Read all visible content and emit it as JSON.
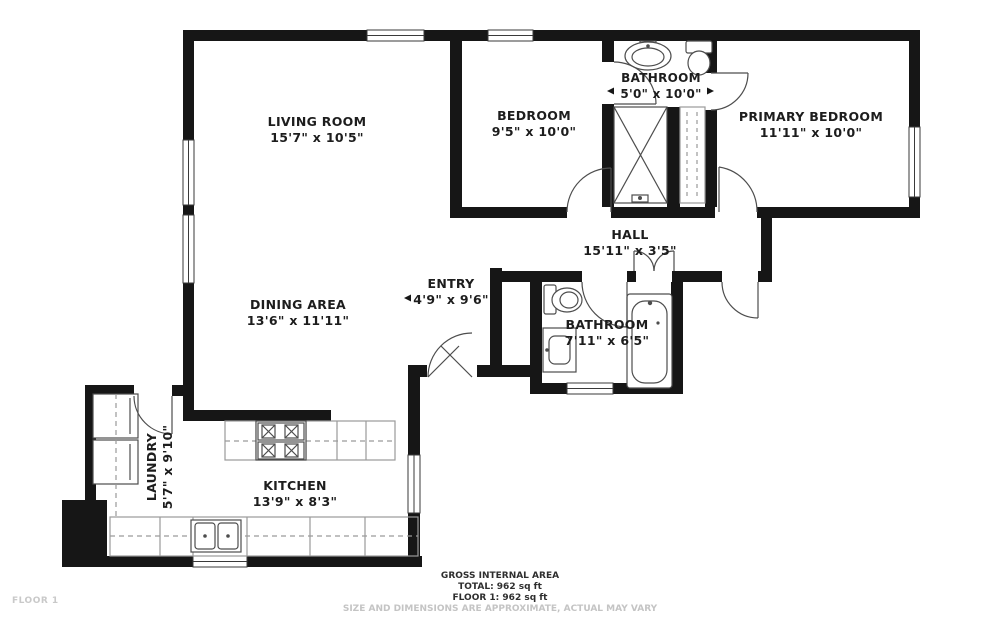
{
  "rooms": [
    {
      "name": "LIVING ROOM",
      "dims": "15'7\" x 10'5\""
    },
    {
      "name": "BEDROOM",
      "dims": "9'5\" x 10'0\""
    },
    {
      "name": "BATHROOM",
      "dims": "5'0\" x 10'0\""
    },
    {
      "name": "PRIMARY BEDROOM",
      "dims": "11'11\" x 10'0\""
    },
    {
      "name": "HALL",
      "dims": "15'11\" x 3'5\""
    },
    {
      "name": "ENTRY",
      "dims": "4'9\" x 9'6\""
    },
    {
      "name": "DINING AREA",
      "dims": "13'6\" x 11'11\""
    },
    {
      "name": "BATHROOM",
      "dims": "7'11\" x 6'5\""
    },
    {
      "name": "LAUNDRY",
      "dims": "5'7\" x 9'10\""
    },
    {
      "name": "KITCHEN",
      "dims": "13'9\" x 8'3\""
    }
  ],
  "footer": {
    "area_title": "GROSS INTERNAL AREA",
    "total": "TOTAL: 962 sq ft",
    "floor_total": "FLOOR 1: 962 sq ft",
    "disclaimer": "SIZE AND DIMENSIONS ARE APPROXIMATE, ACTUAL MAY VARY"
  },
  "floor_label": "FLOOR 1",
  "colors": {
    "wall": "#161616",
    "fixture": "#4d4d4d",
    "counter": "#9a9a9a",
    "text": "#1d1d1d",
    "muted": "#c4c4c4"
  }
}
